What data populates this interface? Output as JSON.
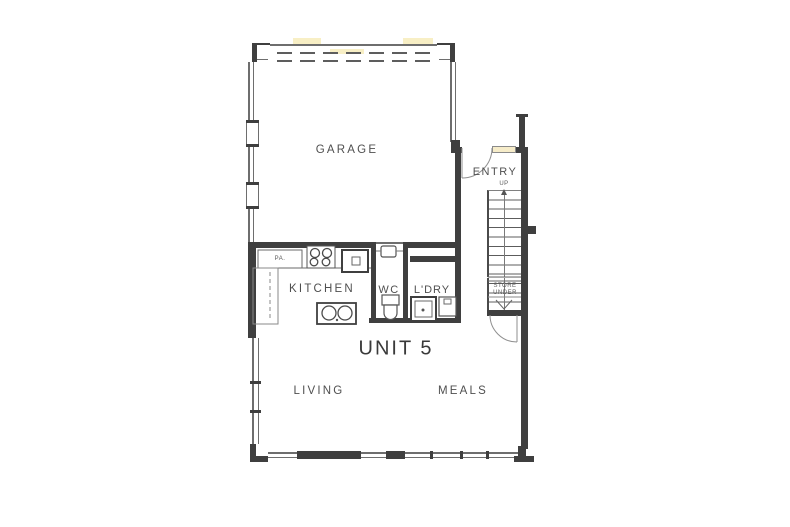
{
  "title": {
    "unit": "UNIT 5"
  },
  "rooms": {
    "garage": {
      "label": "GARAGE"
    },
    "entry": {
      "label": "ENTRY"
    },
    "kitchen": {
      "label": "KITCHEN"
    },
    "wc": {
      "label": "WC"
    },
    "laundry": {
      "label": "L'DRY"
    },
    "living": {
      "label": "LIVING"
    },
    "meals": {
      "label": "MEALS"
    }
  },
  "stairs": {
    "direction_label": "UP",
    "store_label_line1": "STORE",
    "store_label_line2": "UNDER"
  },
  "fixtures": {
    "pantry_label": "PA."
  },
  "colors": {
    "wall": "#3f3f3f",
    "thin_line": "#6e6e6e",
    "text": "#4f4f4f",
    "scan_highlight": "#f3e296",
    "door_sidelight": "#f6ecc9"
  }
}
